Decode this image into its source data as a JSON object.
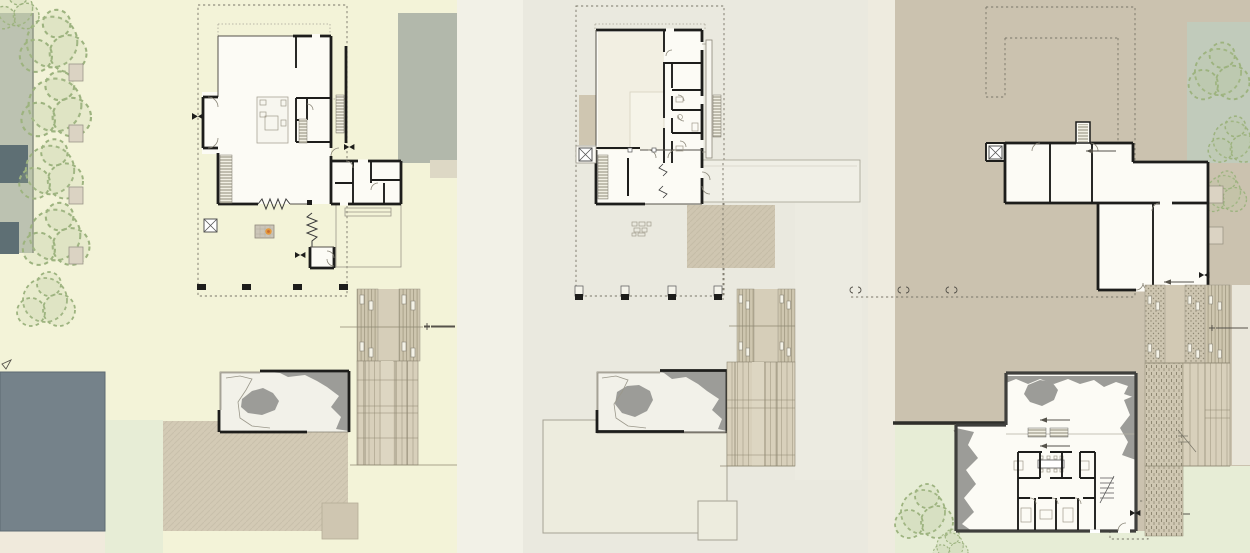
{
  "drawing": {
    "kind": "architectural-site-plan-triptych",
    "panels": [
      {
        "name": "panel-1",
        "plan": "entry-level-plan-with-garden"
      },
      {
        "name": "panel-2",
        "plan": "upper-level-plan"
      },
      {
        "name": "panel-3",
        "plan": "lower-level-plan-with-terrain"
      }
    ]
  },
  "colors": {
    "wall": "#1d1d1b",
    "basemWall": "#3f3f3c",
    "floor": "#fcfbf5",
    "roomBeige": "#f2efe2",
    "bgLeft": "#f3f3d8",
    "bgMid": "#eae9df",
    "bgMidStrip": "#f2f1e7",
    "bgRight": "#cbc2af",
    "green": "#e7edd6",
    "sage": "#bcc2b1",
    "sageSquare": "#c1cbbb",
    "slate": "#75828a",
    "slateDark": "#5e6f74",
    "grayMass": "#b2b8ab",
    "tanPatio": "#d3cab5",
    "tanPatioMid": "#cfc6b1",
    "lightPatio": "#edecde",
    "pondFill": "#f2f1e9",
    "pondGray": "#9c9c98",
    "planter": "#dbd3c3",
    "cream": "#f0eadc",
    "dash": "#7a7668",
    "tree": "#9db37f",
    "treeFill": "rgba(184,200,154,0.18)",
    "flame": "#e59a3c",
    "flameCore": "#c96b2f",
    "siteWall": "#2e2e2a"
  }
}
